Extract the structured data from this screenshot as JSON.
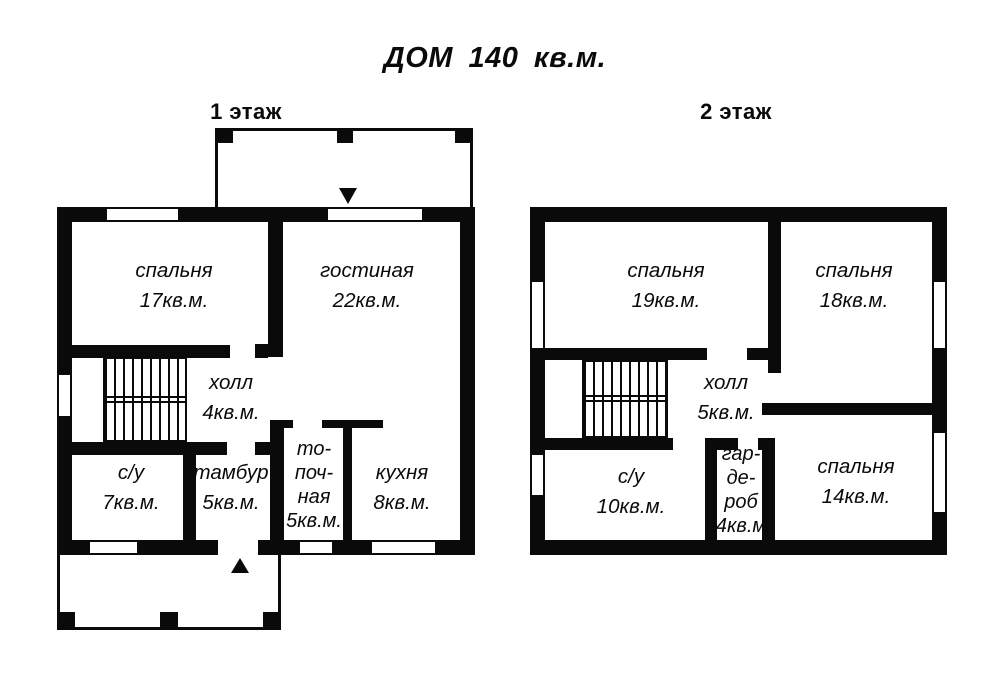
{
  "title": "ДОМ 140 кв.м.",
  "colors": {
    "wall": "#0a0a0a",
    "background": "#ffffff"
  },
  "floor1": {
    "label": "1 этаж",
    "rooms": {
      "bedroom": {
        "name": "спальня",
        "area": "17кв.м."
      },
      "living": {
        "name": "гостиная",
        "area": "22кв.м."
      },
      "hall": {
        "name": "холл",
        "area": "4кв.м."
      },
      "bathroom": {
        "name": "с/у",
        "area": "7кв.м."
      },
      "vestibule": {
        "name": "тамбур",
        "area": "5кв.м."
      },
      "boiler": {
        "name_lines": [
          "то-",
          "поч-",
          "ная"
        ],
        "area": "5кв.м."
      },
      "kitchen": {
        "name": "кухня",
        "area": "8кв.м."
      }
    }
  },
  "floor2": {
    "label": "2 этаж",
    "rooms": {
      "bedroom1": {
        "name": "спальня",
        "area": "19кв.м."
      },
      "bedroom2": {
        "name": "спальня",
        "area": "18кв.м."
      },
      "hall": {
        "name": "холл",
        "area": "5кв.м."
      },
      "bathroom": {
        "name": "с/у",
        "area": "10кв.м."
      },
      "wardrobe": {
        "name_lines": [
          "гар-",
          "де-",
          "роб"
        ],
        "area": "4кв.м"
      },
      "bedroom3": {
        "name": "спальня",
        "area": "14кв.м."
      }
    }
  }
}
